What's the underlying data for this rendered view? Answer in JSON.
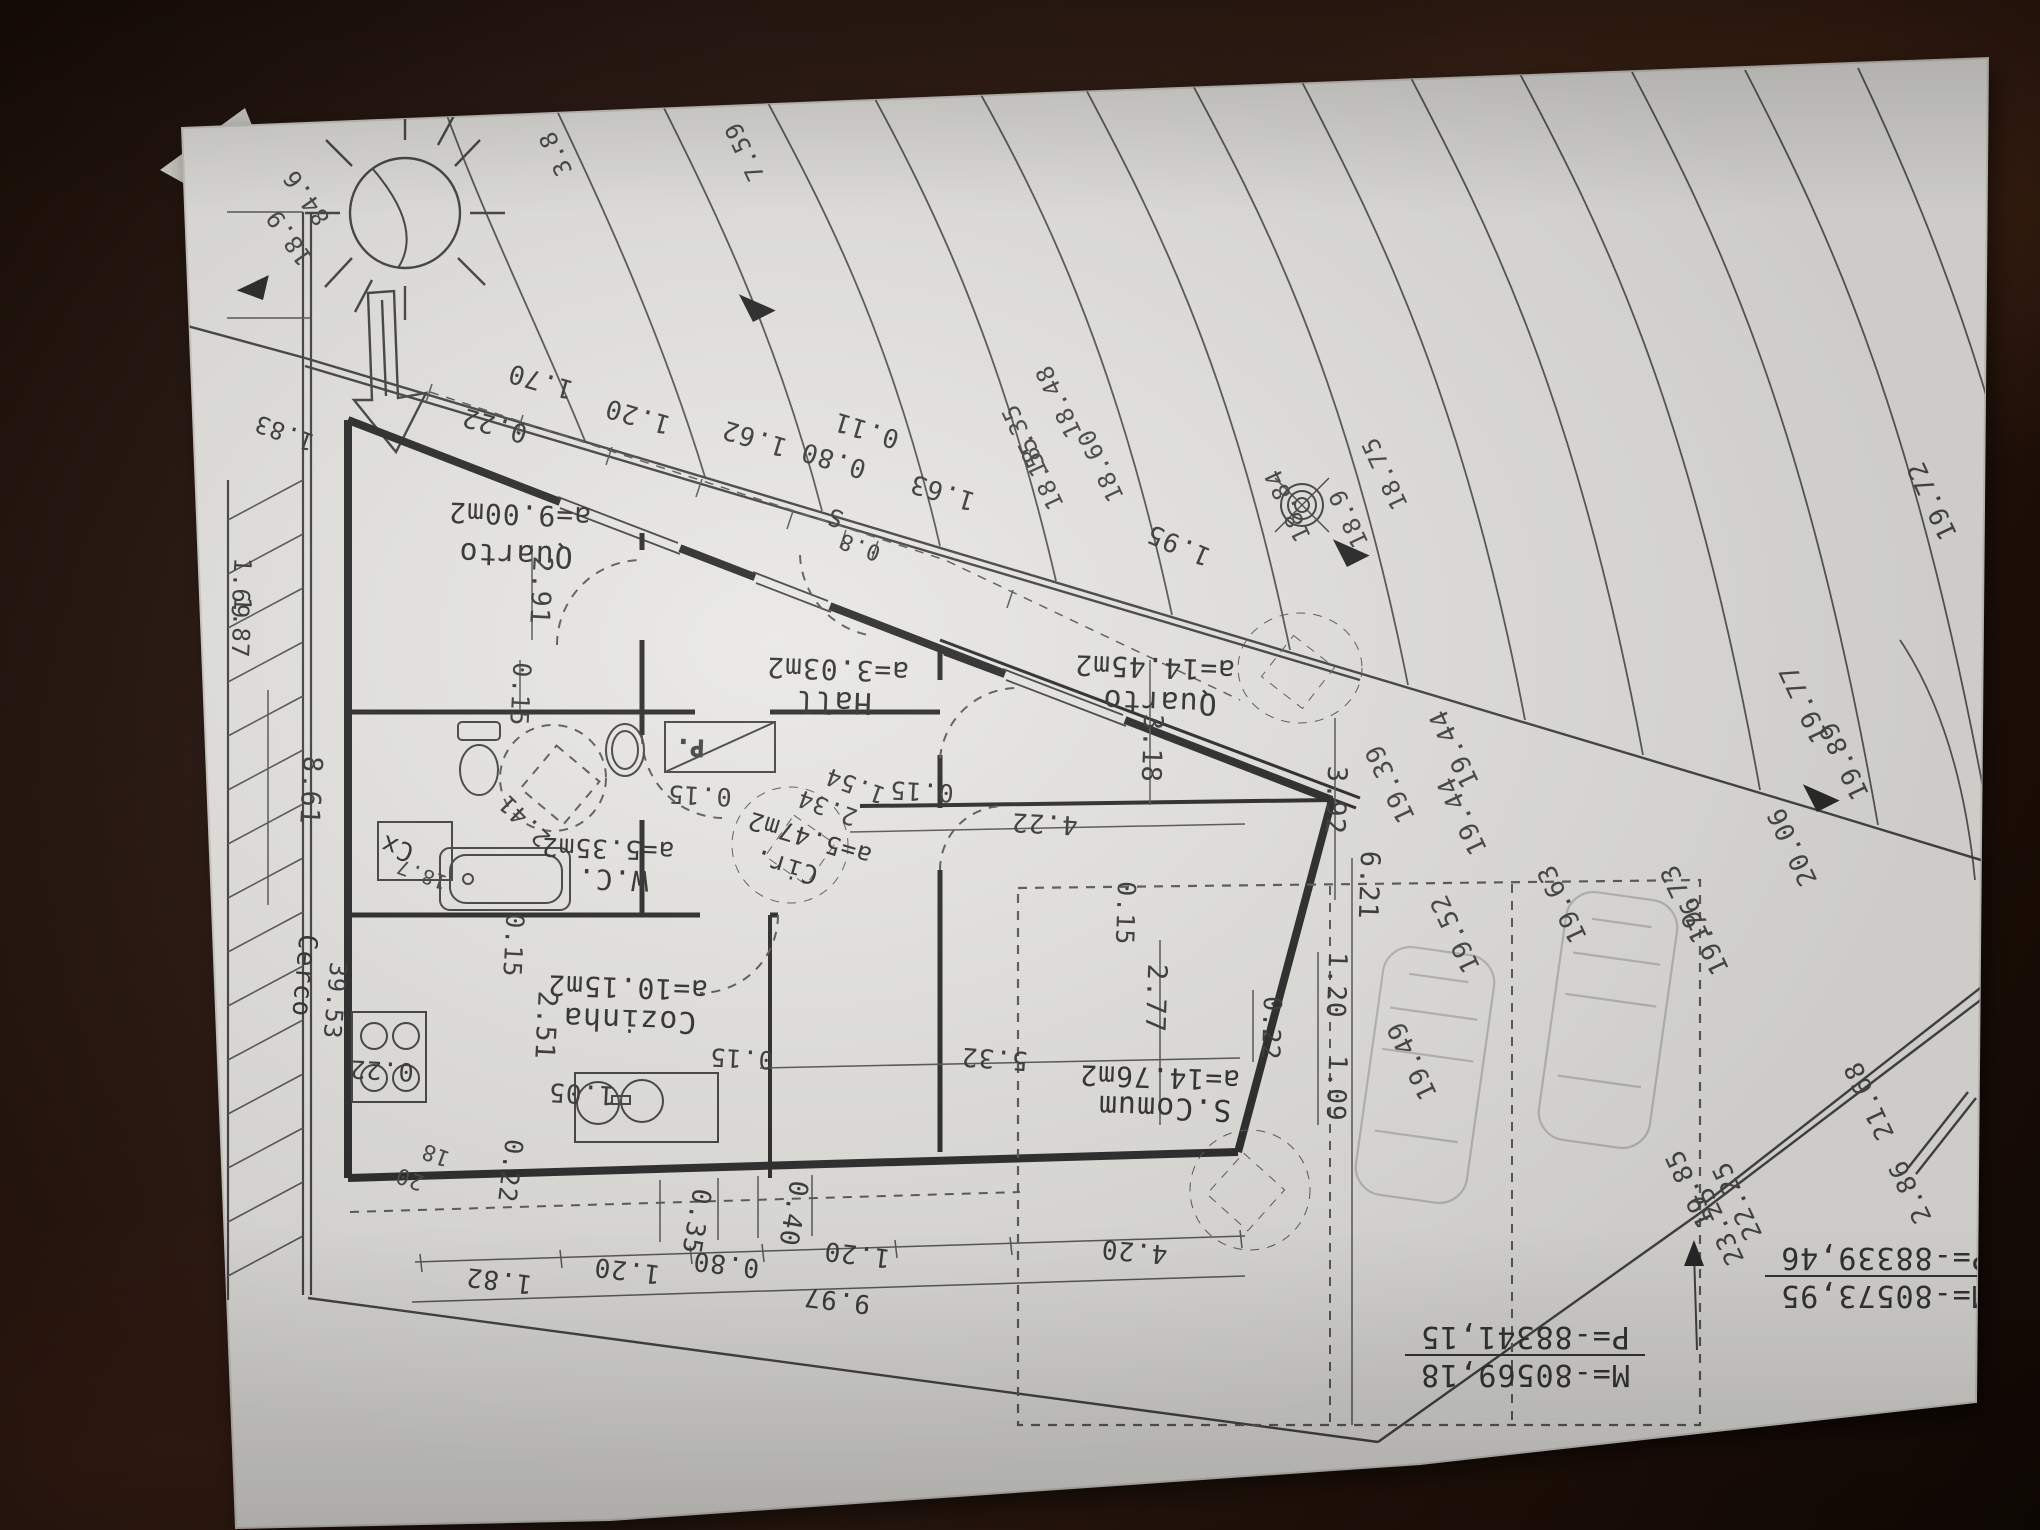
{
  "plan": {
    "colors": {
      "ink": "#3d3d3d",
      "pencil": "#9b9b9b",
      "paper": "#e9e8e4",
      "table": "#22110a"
    },
    "rooms": [
      {
        "name": "Quarto",
        "area": "a=9.00m2"
      },
      {
        "name": "Hall",
        "area": "a=3.03m2"
      },
      {
        "name": "Quarto",
        "area": "a=14.45m2"
      },
      {
        "name": "W.C.",
        "area": "a=5.35m2"
      },
      {
        "name": "Cir.",
        "area": "a=5.47m2"
      },
      {
        "name": "Cozinha",
        "area": "a=10.15m2"
      },
      {
        "name": "S.Comum",
        "area": "a=14.76m2"
      }
    ],
    "coordinates": [
      {
        "m": "M=-80573,95",
        "p": "P=-88339,46",
        "x": 1885,
        "y": 1278
      },
      {
        "m": "M=-80569,18",
        "p": "P=-88341,15",
        "x": 1525,
        "y": 1357
      }
    ],
    "labels": [
      {
        "t": "a=9.00m2",
        "x": 520,
        "y": 505,
        "r": 182,
        "s": 28,
        "c": "room",
        "n": "room-area-quarto-9"
      },
      {
        "t": "Quarto",
        "x": 516,
        "y": 545,
        "r": 182,
        "s": 30,
        "c": "room",
        "n": "room-name-quarto-9"
      },
      {
        "t": "a=3.03m2",
        "x": 838,
        "y": 660,
        "r": 182,
        "s": 28,
        "c": "room",
        "n": "room-area-hall"
      },
      {
        "t": "Hall",
        "x": 834,
        "y": 692,
        "r": 182,
        "s": 30,
        "c": "room",
        "n": "room-name-hall"
      },
      {
        "t": "a=14.45m2",
        "x": 1155,
        "y": 658,
        "r": 182,
        "s": 28,
        "c": "room",
        "n": "room-area-quarto-14"
      },
      {
        "t": "Quarto",
        "x": 1160,
        "y": 692,
        "r": 182,
        "s": 30,
        "c": "room",
        "n": "room-name-quarto-14"
      },
      {
        "t": "a=5.35m2",
        "x": 608,
        "y": 840,
        "r": 182,
        "s": 26,
        "c": "room",
        "n": "room-area-wc"
      },
      {
        "t": "W.C.",
        "x": 613,
        "y": 870,
        "r": 182,
        "s": 28,
        "c": "room",
        "n": "room-name-wc"
      },
      {
        "t": "a=5.47m2",
        "x": 812,
        "y": 830,
        "r": 197,
        "s": 25,
        "c": "room",
        "n": "room-area-cir"
      },
      {
        "t": "Cir.",
        "x": 788,
        "y": 858,
        "r": 197,
        "s": 26,
        "c": "room",
        "n": "room-name-cir"
      },
      {
        "t": "a=10.15m2",
        "x": 628,
        "y": 978,
        "r": 182,
        "s": 28,
        "c": "room",
        "n": "room-area-cozinha"
      },
      {
        "t": "Cozinha",
        "x": 630,
        "y": 1010,
        "r": 182,
        "s": 30,
        "c": "room",
        "n": "room-name-cozinha"
      },
      {
        "t": "a=14.76m2",
        "x": 1160,
        "y": 1068,
        "r": 182,
        "s": 28,
        "c": "room",
        "n": "room-area-scomum"
      },
      {
        "t": "S.Comum",
        "x": 1165,
        "y": 1098,
        "r": 182,
        "s": 30,
        "c": "room",
        "n": "room-name-scomum"
      },
      {
        "t": "0.22",
        "x": 497,
        "y": 417,
        "r": 196,
        "s": 26
      },
      {
        "t": "1.70",
        "x": 543,
        "y": 373,
        "r": 196,
        "s": 26
      },
      {
        "t": "1.20",
        "x": 640,
        "y": 408,
        "r": 196,
        "s": 26
      },
      {
        "t": "1.62",
        "x": 757,
        "y": 430,
        "r": 197,
        "s": 26
      },
      {
        "t": "0.80",
        "x": 836,
        "y": 452,
        "r": 197,
        "s": 26
      },
      {
        "t": "0.11",
        "x": 869,
        "y": 422,
        "r": 197,
        "s": 26
      },
      {
        "t": "1.63",
        "x": 945,
        "y": 484,
        "r": 197,
        "s": 26
      },
      {
        "t": "1.95",
        "x": 1182,
        "y": 537,
        "r": 203,
        "s": 26
      },
      {
        "t": "0.15",
        "x": 700,
        "y": 787,
        "r": 183,
        "s": 25
      },
      {
        "t": "0.15",
        "x": 922,
        "y": 783,
        "r": 183,
        "s": 25
      },
      {
        "t": "4.22",
        "x": 1045,
        "y": 815,
        "r": 183,
        "s": 26
      },
      {
        "t": "0.15",
        "x": 742,
        "y": 1050,
        "r": 183,
        "s": 25
      },
      {
        "t": "1.05",
        "x": 582,
        "y": 1085,
        "r": 183,
        "s": 26
      },
      {
        "t": "0.22",
        "x": 382,
        "y": 1062,
        "r": 183,
        "s": 25
      },
      {
        "t": "1.82",
        "x": 500,
        "y": 1272,
        "r": 187,
        "s": 26
      },
      {
        "t": "1.20",
        "x": 628,
        "y": 1262,
        "r": 187,
        "s": 26
      },
      {
        "t": "0.80",
        "x": 727,
        "y": 1256,
        "r": 187,
        "s": 26
      },
      {
        "t": "1.20",
        "x": 858,
        "y": 1246,
        "r": 187,
        "s": 26
      },
      {
        "t": "9.97",
        "x": 838,
        "y": 1292,
        "r": 187,
        "s": 26
      },
      {
        "t": "4.20",
        "x": 1135,
        "y": 1243,
        "r": 185,
        "s": 26
      },
      {
        "t": "5.32",
        "x": 995,
        "y": 1050,
        "r": 184,
        "s": 26
      },
      {
        "t": "2.34",
        "x": 830,
        "y": 800,
        "r": 200,
        "s": 24
      },
      {
        "t": "1.54",
        "x": 858,
        "y": 778,
        "r": 200,
        "s": 24
      },
      {
        "t": "2.41",
        "x": 530,
        "y": 815,
        "r": 225,
        "s": 24
      },
      {
        "t": "0.22",
        "x": 502,
        "y": 1170,
        "r": 97,
        "s": 25
      },
      {
        "t": "0.35",
        "x": 688,
        "y": 1220,
        "r": 100,
        "s": 26
      },
      {
        "t": "0.40",
        "x": 785,
        "y": 1212,
        "r": 100,
        "s": 26
      },
      {
        "t": "2.91",
        "x": 532,
        "y": 590,
        "r": 93,
        "s": 27
      },
      {
        "t": "0.15",
        "x": 512,
        "y": 694,
        "r": 93,
        "s": 25
      },
      {
        "t": "2.51",
        "x": 537,
        "y": 1025,
        "r": 93,
        "s": 27
      },
      {
        "t": "0.15",
        "x": 505,
        "y": 945,
        "r": 93,
        "s": 25
      },
      {
        "t": "0.15",
        "x": 1117,
        "y": 913,
        "r": 92,
        "s": 25
      },
      {
        "t": "3.18",
        "x": 1143,
        "y": 748,
        "r": 92,
        "s": 27
      },
      {
        "t": "2.77",
        "x": 1147,
        "y": 998,
        "r": 92,
        "s": 27
      },
      {
        "t": "0.22",
        "x": 1263,
        "y": 1028,
        "r": 92,
        "s": 25
      },
      {
        "t": "1.20",
        "x": 1328,
        "y": 985,
        "r": 92,
        "s": 26
      },
      {
        "t": "1.09",
        "x": 1328,
        "y": 1088,
        "r": 92,
        "s": 26
      },
      {
        "t": "3.92",
        "x": 1327,
        "y": 800,
        "r": 92,
        "s": 27
      },
      {
        "t": "6.21",
        "x": 1360,
        "y": 885,
        "r": 92,
        "s": 27
      },
      {
        "t": "8.61",
        "x": 302,
        "y": 790,
        "r": 93,
        "s": 27
      },
      {
        "t": "Cerco",
        "x": 296,
        "y": 975,
        "r": 95,
        "s": 26,
        "c": "room",
        "n": "site-label-cerco"
      },
      {
        "t": "39.53",
        "x": 327,
        "y": 1000,
        "r": 95,
        "s": 24
      },
      {
        "t": "1.69",
        "x": 233,
        "y": 588,
        "r": 93,
        "s": 24
      },
      {
        "t": "1.87",
        "x": 233,
        "y": 627,
        "r": 93,
        "s": 24
      },
      {
        "t": "1.83",
        "x": 287,
        "y": 425,
        "r": 200,
        "s": 24
      },
      {
        "t": "18.9",
        "x": 296,
        "y": 233,
        "r": 235,
        "s": 24,
        "c": "elev"
      },
      {
        "t": "84.6",
        "x": 313,
        "y": 193,
        "r": 235,
        "s": 24,
        "c": "elev"
      },
      {
        "t": "18",
        "x": 438,
        "y": 1148,
        "r": 200,
        "s": 22,
        "c": "elev"
      },
      {
        "t": "20",
        "x": 412,
        "y": 1172,
        "r": 200,
        "s": 22,
        "c": "elev"
      },
      {
        "t": "S",
        "x": 838,
        "y": 510,
        "r": 200,
        "s": 24
      },
      {
        "t": "0.8",
        "x": 862,
        "y": 540,
        "r": 200,
        "s": 22
      },
      {
        "t": "Cx",
        "x": 400,
        "y": 840,
        "r": 200,
        "s": 26,
        "c": "room",
        "n": "site-label-cx"
      },
      {
        "t": "18.7",
        "x": 424,
        "y": 868,
        "r": 200,
        "s": 20,
        "c": "elev"
      },
      {
        "t": "19.44",
        "x": 1462,
        "y": 745,
        "r": 245,
        "s": 26,
        "c": "elev"
      },
      {
        "t": "19.44",
        "x": 1470,
        "y": 812,
        "r": 245,
        "s": 26,
        "c": "elev"
      },
      {
        "t": "19.39",
        "x": 1398,
        "y": 780,
        "r": 245,
        "s": 26,
        "c": "elev"
      },
      {
        "t": "19.52",
        "x": 1463,
        "y": 930,
        "r": 245,
        "s": 26,
        "c": "elev"
      },
      {
        "t": "19.49",
        "x": 1420,
        "y": 1057,
        "r": 245,
        "s": 26,
        "c": "elev"
      },
      {
        "t": "19.63",
        "x": 1570,
        "y": 900,
        "r": 245,
        "s": 26,
        "c": "elev"
      },
      {
        "t": "19.73",
        "x": 1693,
        "y": 900,
        "r": 245,
        "s": 26,
        "c": "elev"
      },
      {
        "t": "19.76",
        "x": 1712,
        "y": 932,
        "r": 245,
        "s": 26,
        "c": "elev"
      },
      {
        "t": "19.85",
        "x": 1698,
        "y": 1185,
        "r": 245,
        "s": 26,
        "c": "elev"
      },
      {
        "t": "23.25",
        "x": 1727,
        "y": 1222,
        "r": 245,
        "s": 26,
        "c": "elev"
      },
      {
        "t": "21.68",
        "x": 1877,
        "y": 1097,
        "r": 245,
        "s": 26,
        "c": "elev"
      },
      {
        "t": "22.25",
        "x": 1745,
        "y": 1197,
        "r": 245,
        "s": 26,
        "c": "elev"
      },
      {
        "t": "2.86",
        "x": 1918,
        "y": 1188,
        "r": 245,
        "s": 26,
        "c": "elev"
      },
      {
        "t": "19.72",
        "x": 1940,
        "y": 497,
        "r": 245,
        "s": 26,
        "c": "elev"
      },
      {
        "t": "19.77",
        "x": 1812,
        "y": 700,
        "r": 245,
        "s": 26,
        "c": "elev"
      },
      {
        "t": "19.89",
        "x": 1852,
        "y": 757,
        "r": 245,
        "s": 26,
        "c": "elev"
      },
      {
        "t": "20.06",
        "x": 1800,
        "y": 843,
        "r": 245,
        "s": 26,
        "c": "elev"
      },
      {
        "t": "18.35",
        "x": 1032,
        "y": 437,
        "r": 245,
        "s": 24,
        "c": "elev"
      },
      {
        "t": "18.48",
        "x": 1066,
        "y": 398,
        "r": 245,
        "s": 24,
        "c": "elev"
      },
      {
        "t": "18.55",
        "x": 1048,
        "y": 470,
        "r": 245,
        "s": 24,
        "c": "elev"
      },
      {
        "t": "18.60",
        "x": 1108,
        "y": 462,
        "r": 245,
        "s": 24,
        "c": "elev"
      },
      {
        "t": "18.75",
        "x": 1392,
        "y": 470,
        "r": 245,
        "s": 24,
        "c": "elev"
      },
      {
        "t": "18.84",
        "x": 1295,
        "y": 502,
        "r": 245,
        "s": 24,
        "c": "elev"
      },
      {
        "t": "18.9",
        "x": 1356,
        "y": 515,
        "r": 245,
        "s": 24,
        "c": "elev"
      },
      {
        "t": "3.8",
        "x": 563,
        "y": 150,
        "r": 245,
        "s": 24,
        "c": "elev"
      },
      {
        "t": "7.59",
        "x": 752,
        "y": 148,
        "r": 245,
        "s": 24,
        "c": "elev"
      }
    ]
  }
}
